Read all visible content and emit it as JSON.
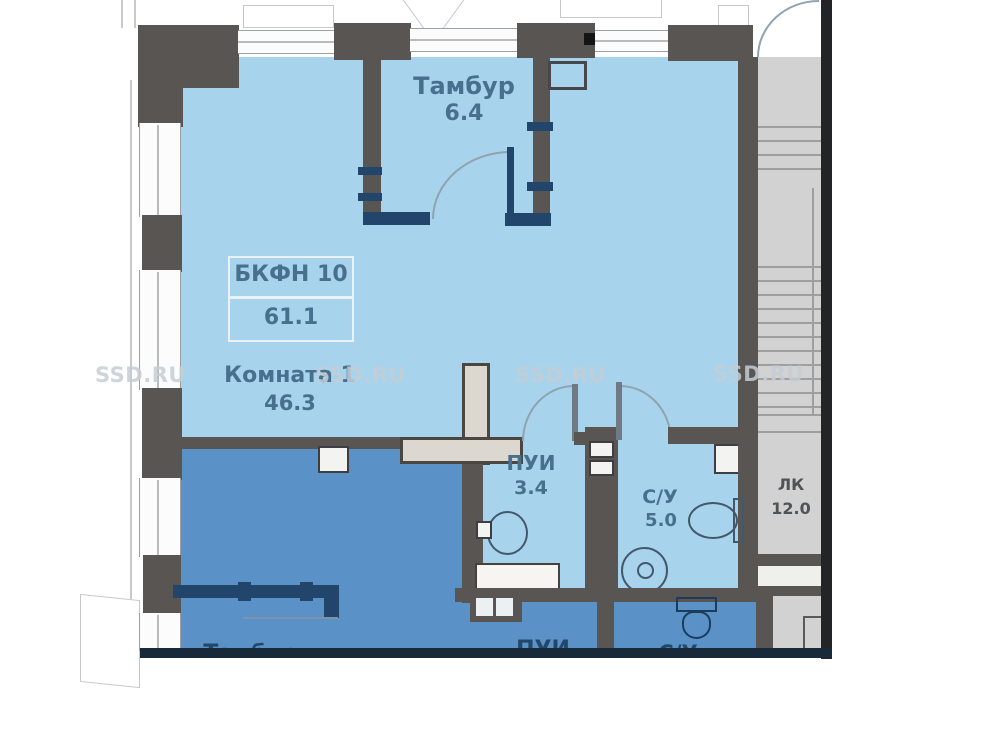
{
  "watermark": {
    "text": "SSD.RU"
  },
  "plan": {
    "unit_label": "БКФН 10",
    "unit_area": "61.1",
    "rooms": {
      "tambur_top": {
        "name": "Тамбур",
        "area": "6.4"
      },
      "komnata": {
        "name": "Комната 1",
        "area": "46.3"
      },
      "pui": {
        "name": "ПУИ",
        "area": "3.4"
      },
      "su": {
        "name": "С/У",
        "area": "5.0"
      },
      "lk": {
        "name": "ЛК",
        "area": "12.0"
      },
      "tambur_bottom": {
        "name": "Тамбур"
      },
      "pui_bottom": {
        "name": "ПУИ"
      },
      "su_bottom": {
        "name": "С/У"
      }
    },
    "colors": {
      "room_light": "#a8d3ec",
      "room_dark": "#5a92c8",
      "wall_dark": "#585552",
      "partition_navy": "#22456b",
      "stair_gray": "#d2d2d2",
      "outer_wall": "#222426"
    }
  }
}
